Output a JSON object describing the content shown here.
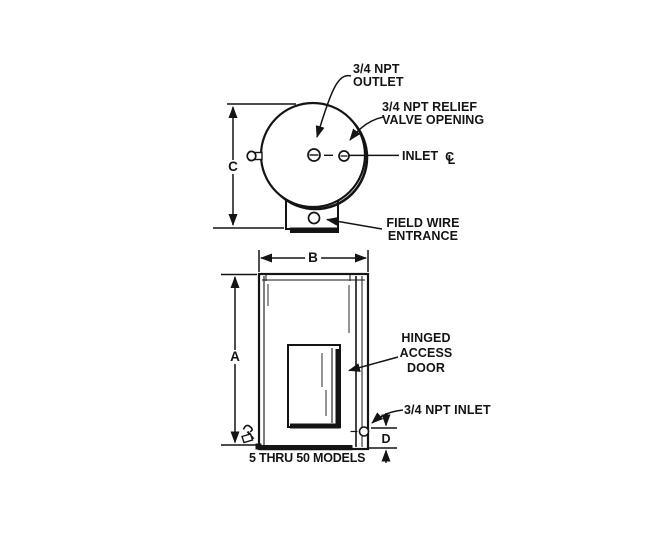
{
  "colors": {
    "ink": "#141414",
    "paper": "#ffffff"
  },
  "top_view": {
    "outlet_label": "3/4 NPT\nOUTLET",
    "relief_valve_label": "3/4 NPT RELIEF\nVALVE OPENING",
    "inlet_label": "INLET",
    "centerline_c": "C",
    "centerline_l": "L",
    "field_wire_label": "FIELD WIRE\nENTRANCE",
    "dim_c": "C"
  },
  "front_view": {
    "hinged_door_label": "HINGED\nACCESS\nDOOR",
    "npt_inlet_label": "3/4 NPT INLET",
    "models_label": "5 THRU 50 MODELS",
    "dim_a": "A",
    "dim_b": "B",
    "dim_d": "D"
  }
}
